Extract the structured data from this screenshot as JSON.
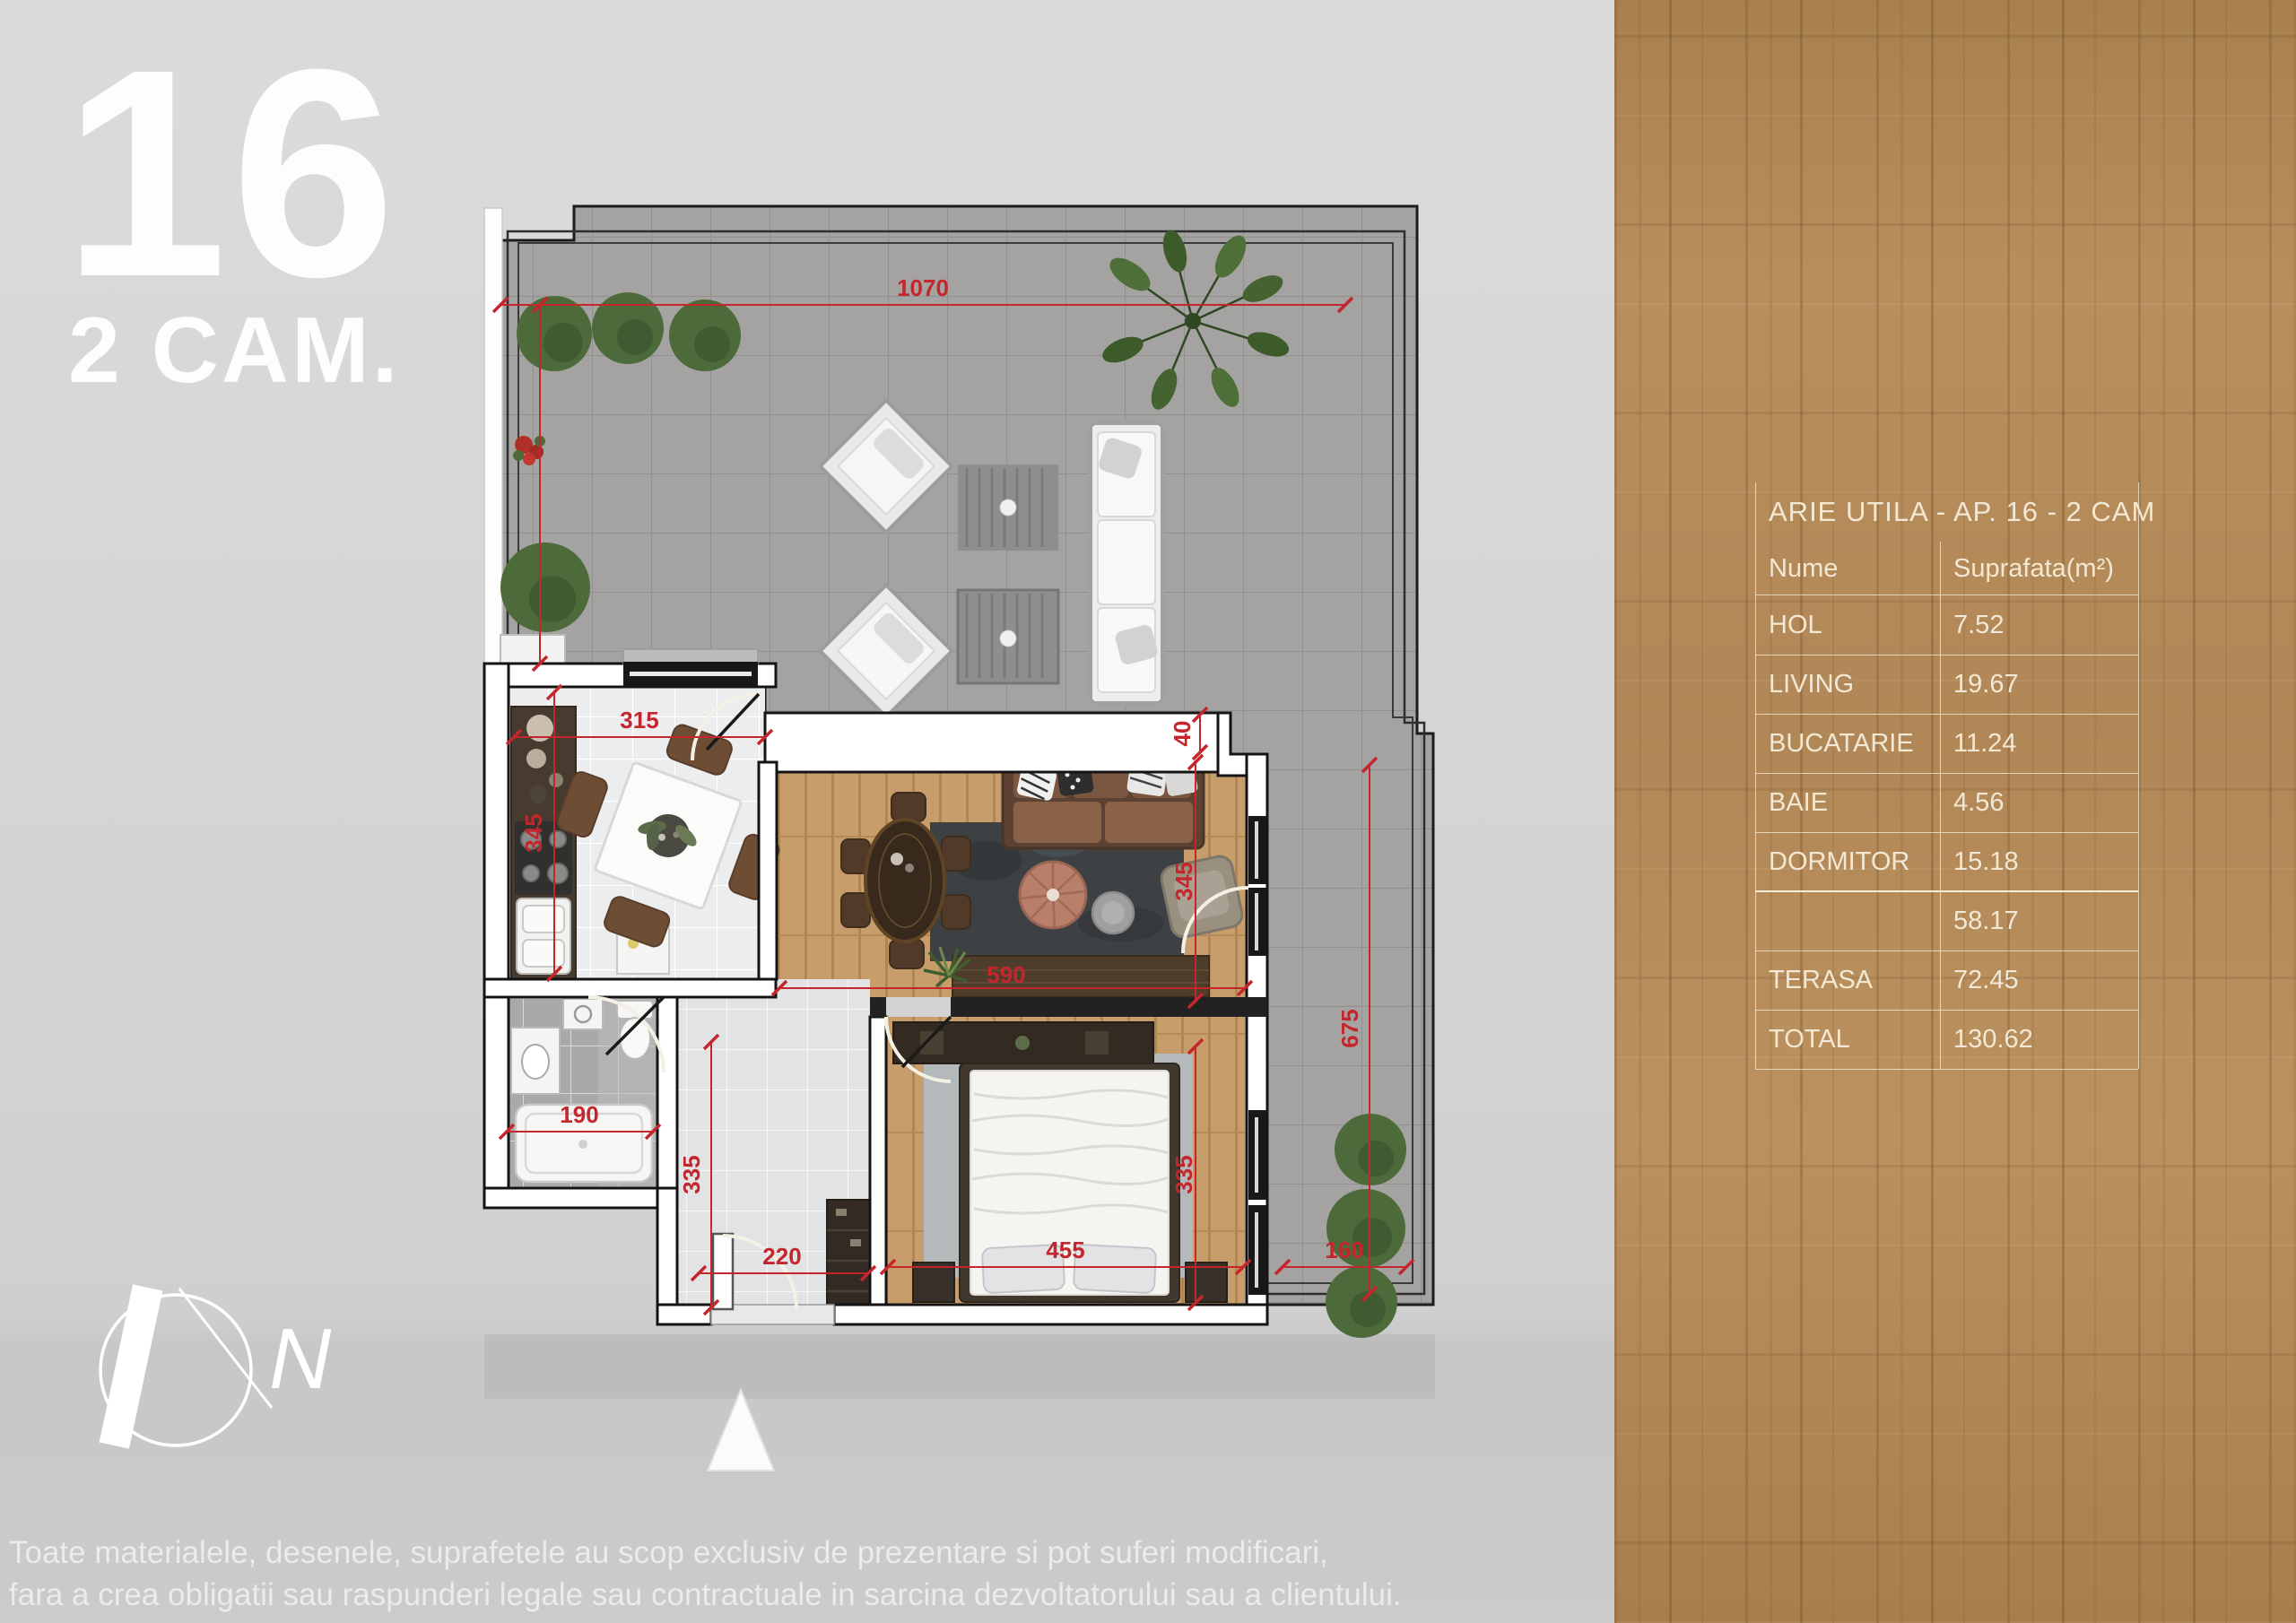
{
  "apartment": {
    "number": "16",
    "type_label": "2 CAM."
  },
  "area_table": {
    "title": "ARIE UTILA - AP. 16 - 2 CAM",
    "columns": {
      "name": "Nume",
      "area": "Suprafata(m²)"
    },
    "rows": [
      {
        "name": "HOL",
        "area": "7.52"
      },
      {
        "name": "LIVING",
        "area": "19.67"
      },
      {
        "name": "BUCATARIE",
        "area": "11.24"
      },
      {
        "name": "BAIE",
        "area": "4.56"
      },
      {
        "name": "DORMITOR",
        "area": "15.18"
      },
      {
        "name": "",
        "area": "58.17"
      },
      {
        "name": "TERASA",
        "area": "72.45"
      },
      {
        "name": "TOTAL",
        "area": "130.62"
      }
    ]
  },
  "dimensions": {
    "terrace_front": "1070",
    "kitchen_width": "315",
    "kitchen_depth": "345",
    "wall_step": "40",
    "living_depth": "345",
    "living_width": "590",
    "terrace_side": "675",
    "bathroom_width": "190",
    "hall_depth": "335",
    "hall_width": "220",
    "bedroom_width": "455",
    "bedroom_depth": "335",
    "side_terrace_width": "160"
  },
  "compass": {
    "north_label": "N"
  },
  "disclaimer": {
    "line1": "Toate materialele, desenele, suprafetele au scop exclusiv de prezentare si pot suferi modificari,",
    "line2": "fara a crea obligatii sau raspunderi legale sau contractuale in sarcina dezvoltatorului sau a clientului."
  },
  "colors": {
    "dimension_red": "#c4262c",
    "wood_panel": "#b28757",
    "table_text": "#f2e8d4"
  }
}
